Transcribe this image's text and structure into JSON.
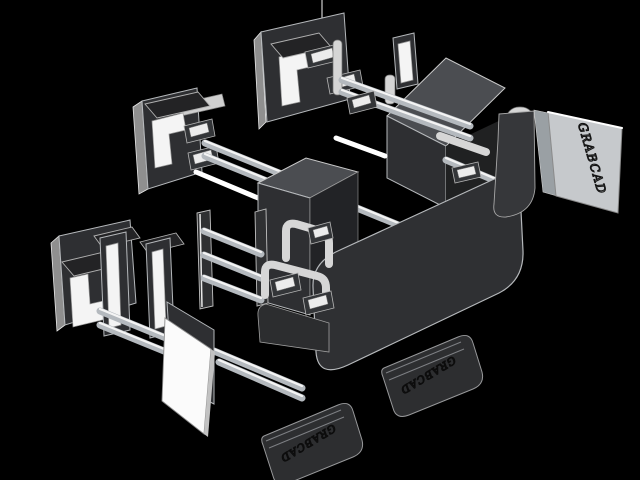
{
  "engravings": {
    "side_panel": "GRABCAD",
    "front_tab": "GRABCAD",
    "left_tab": "GRABCAD"
  },
  "colors": {
    "background": "#000000",
    "part_dark": "#2e2f32",
    "part_mid": "#4b4d51",
    "part_light": "#c6c9cc",
    "highlight": "#f4f4f4",
    "edge": "#b5b8bb",
    "engraving_dark": "#0c0c0c",
    "engraving_panel": "#141414"
  }
}
